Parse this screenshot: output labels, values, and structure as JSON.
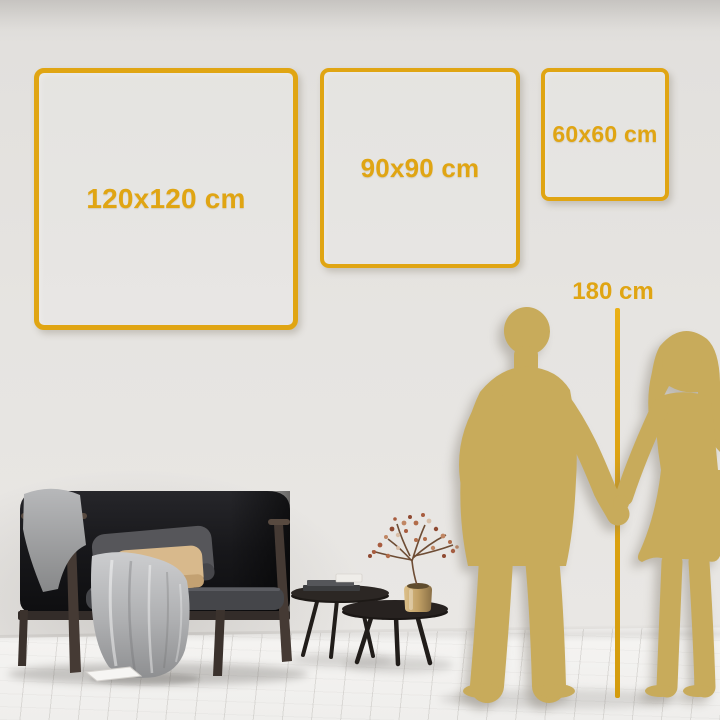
{
  "title": "Wall art size comparison guide",
  "colors": {
    "gold": "#E0A513",
    "silhouette": "#C8AB5B"
  },
  "size_options": [
    {
      "id": "frame-120",
      "label": "120x120 cm",
      "width_cm": 120,
      "height_cm": 120
    },
    {
      "id": "frame-90",
      "label": "90x90 cm",
      "width_cm": 90,
      "height_cm": 90
    },
    {
      "id": "frame-60",
      "label": "60x60 cm",
      "width_cm": 60,
      "height_cm": 60
    }
  ],
  "height_reference": {
    "label": "180 cm",
    "value_cm": 180
  },
  "scene": {
    "icons": [
      "sofa-icon",
      "throw-blanket-icon",
      "cushion-gray-icon",
      "cushion-beige-icon",
      "nesting-coffee-tables-icon",
      "book-stack-icon",
      "brass-vase-icon",
      "dried-flowers-icon",
      "floor-paper-icon",
      "man-silhouette-icon",
      "woman-silhouette-icon",
      "height-ruler-icon"
    ]
  }
}
